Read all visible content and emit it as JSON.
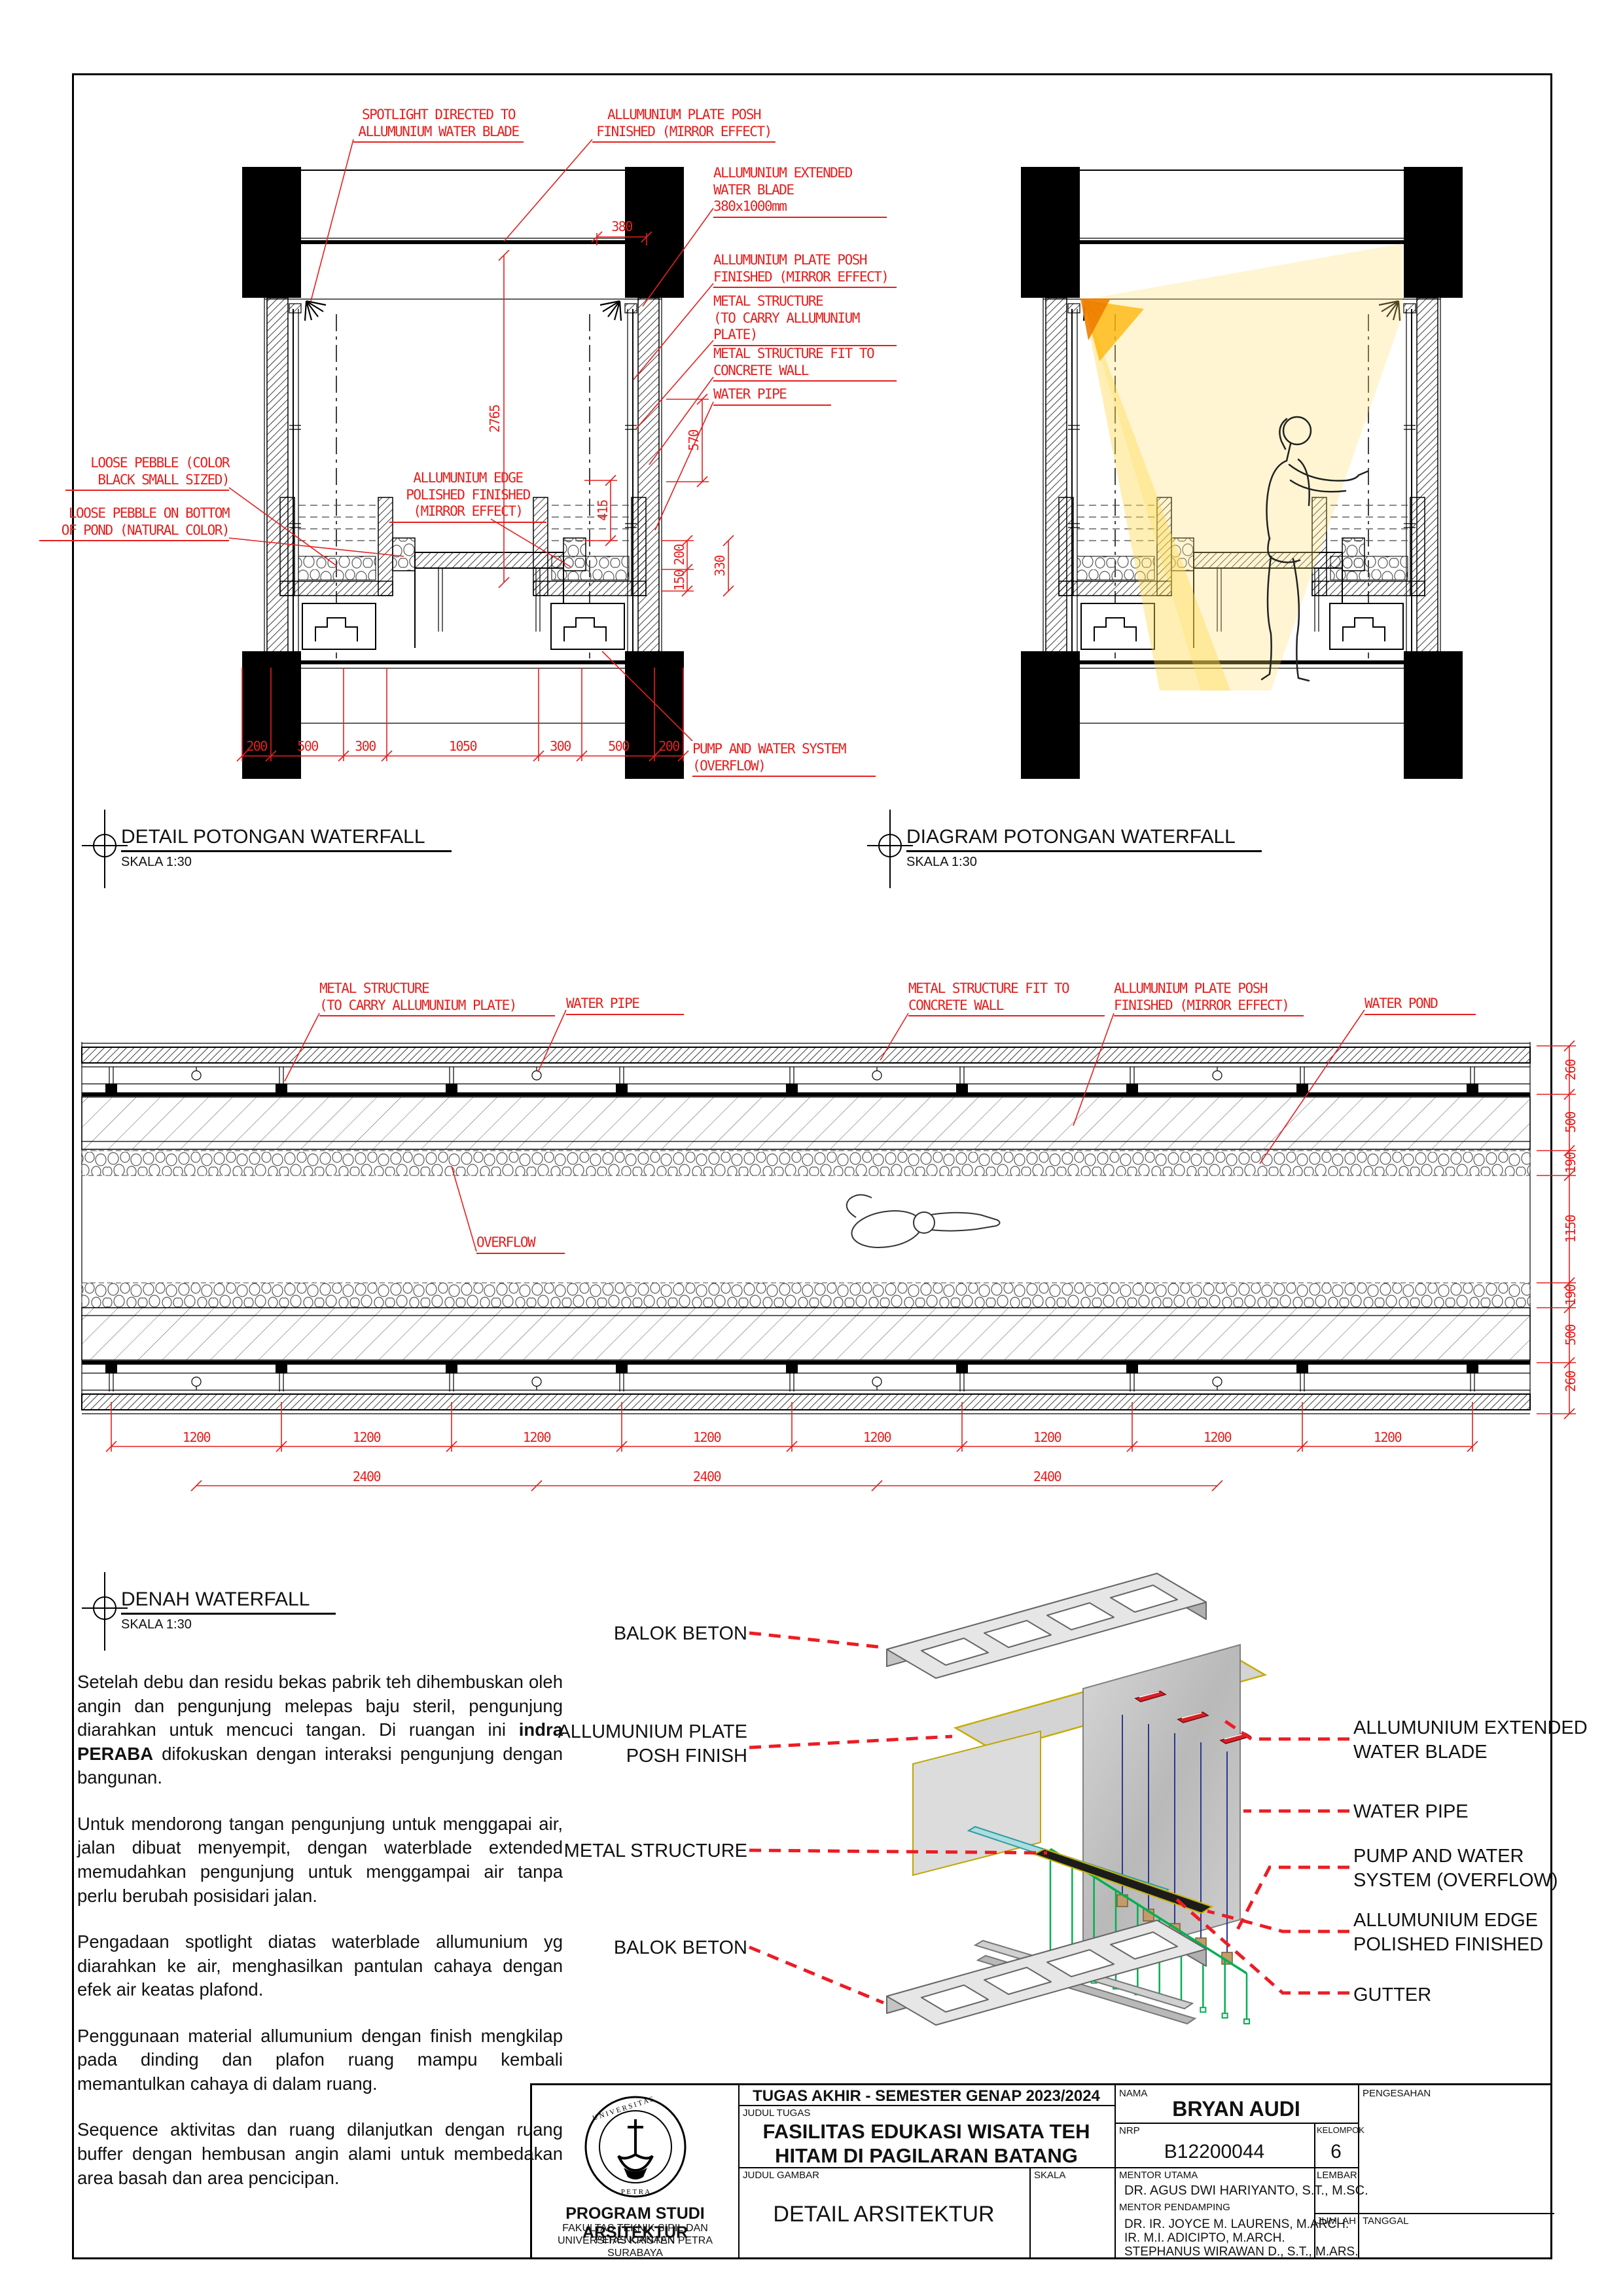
{
  "colors": {
    "annotation_red": "#e3201f",
    "leader_red": "#ed1c24",
    "structure_green": "#00b050",
    "pipe_blue": "#2b3990",
    "gutter_cyan": "#9fd8dc",
    "spotlight_yellow": "#ffd84d",
    "plate_edge_yellow": "#c6ac00"
  },
  "detail_section": {
    "title": "DETAIL POTONGAN WATERFALL",
    "scale_label": "SKALA 1:30",
    "labels": {
      "spotlight": "SPOTLIGHT DIRECTED TO\nALLUMUNIUM WATER BLADE",
      "plate_top": "ALLUMUNIUM PLATE POSH\nFINISHED (MIRROR EFFECT)",
      "water_blade": "ALLUMUNIUM EXTENDED\nWATER BLADE\n380x1000mm",
      "plate_right": "ALLUMUNIUM PLATE POSH\nFINISHED (MIRROR EFFECT)",
      "metal_carry": "METAL STRUCTURE\n(TO CARRY ALLUMUNIUM\nPLATE)",
      "metal_fit": "METAL STRUCTURE FIT TO\nCONCRETE WALL",
      "water_pipe": "WATER PIPE",
      "pebble_black": "LOOSE PEBBLE (COLOR\nBLACK SMALL SIZED)",
      "pebble_bottom": "LOOSE PEBBLE ON BOTTOM\nOF POND (NATURAL COLOR)",
      "alu_edge": "ALLUMUNIUM EDGE\nPOLISHED FINISHED\n(MIRROR EFFECT)",
      "pump": "PUMP AND WATER SYSTEM\n(OVERFLOW)"
    },
    "dims": {
      "w380": "380",
      "h2765": "2765",
      "h570": "570",
      "h415": "415",
      "h200": "200",
      "h150": "150",
      "h330": "330",
      "bottom": [
        "200",
        "500",
        "300",
        "1050",
        "300",
        "500",
        "200"
      ]
    }
  },
  "diagram_section": {
    "title": "DIAGRAM POTONGAN WATERFALL",
    "scale_label": "SKALA 1:30"
  },
  "plan": {
    "title": "DENAH WATERFALL",
    "scale_label": "SKALA 1:30",
    "labels": {
      "metal_carry": "METAL STRUCTURE\n(TO CARRY ALLUMUNIUM PLATE)",
      "water_pipe": "WATER PIPE",
      "metal_fit": "METAL STRUCTURE FIT TO\nCONCRETE WALL",
      "plate": "ALLUMUNIUM PLATE POSH\nFINISHED (MIRROR EFFECT)",
      "water_pond": "WATER POND",
      "overflow": "OVERFLOW"
    },
    "dims": {
      "right": [
        "260",
        "500",
        "190",
        "1150",
        "190",
        "500",
        "260"
      ],
      "bottom_1200": [
        "1200",
        "1200",
        "1200",
        "1200",
        "1200",
        "1200",
        "1200",
        "1200"
      ],
      "bottom_2400": [
        "2400",
        "2400",
        "2400"
      ]
    }
  },
  "axon": {
    "labels": {
      "balok_beton_top": "BALOK BETON",
      "plate_posh": "ALLUMUNIUM PLATE\nPOSH FINISH",
      "metal_structure": "METAL STRUCTURE",
      "balok_beton_bottom": "BALOK BETON",
      "water_blade": "ALLUMUNIUM EXTENDED\nWATER BLADE",
      "water_pipe": "WATER PIPE",
      "pump": "PUMP AND WATER\nSYSTEM (OVERFLOW)",
      "alu_edge": "ALLUMUNIUM EDGE\nPOLISHED FINISHED",
      "gutter": "GUTTER"
    }
  },
  "notes": {
    "p1_pre": "Setelah debu dan residu bekas  pabrik teh dihembuskan oleh angin dan pengunjung melepas baju steril, pengunjung diarahkan untuk mencuci tangan. Di ruangan ini ",
    "p1_bold": "indra PERABA",
    "p1_post": " difokuskan dengan interaksi pengunjung dengan bangunan.",
    "p2": "Untuk mendorong tangan pengunjung untuk menggapai air, jalan dibuat menyempit, dengan waterblade extended memudahkan pengunjung untuk menggampai air tanpa perlu berubah posisidari jalan.",
    "p3": "Pengadaan spotlight diatas waterblade allumunium yg diarahkan ke air, menghasilkan pantulan cahaya dengan efek air keatas plafond.",
    "p4": "Penggunaan material allumunium dengan finish mengkilap pada dinding dan plafon ruang mampu kembali memantulkan cahaya di dalam ruang.",
    "p5": "Sequence aktivitas dan ruang dilanjutkan dengan ruang buffer dengan hembusan angin alami untuk membedakan area basah dan area pencicipan."
  },
  "titleblock": {
    "header": "TUGAS AKHIR - SEMESTER GENAP 2023/2024",
    "judul_tugas_label": "JUDUL TUGAS",
    "judul_tugas": "FASILITAS EDUKASI WISATA TEH\nHITAM DI PAGILARAN BATANG",
    "judul_gambar_label": "JUDUL GAMBAR",
    "judul_gambar": "DETAIL ARSITEKTUR",
    "skala_label": "SKALA",
    "nama_label": "NAMA",
    "nama": "BRYAN AUDI",
    "nrp_label": "NRP",
    "nrp": "B12200044",
    "kelompok_label": "KELOMPOK",
    "kelompok": "6",
    "mentor_utama_label": "MENTOR UTAMA",
    "mentor_utama": "DR. AGUS DWI HARIYANTO, S.T., M.SC.",
    "mentor_pendamping_label": "MENTOR PENDAMPING",
    "pendamping": [
      "DR. IR. JOYCE M. LAURENS, M.ARCH.",
      "IR. M.I. ADICIPTO, M.ARCH.",
      "STEPHANUS WIRAWAN D., S.T., M.ARS."
    ],
    "lembar_label": "LEMBAR",
    "jumlah_label": "JUMLAH",
    "pengesahan_label": "PENGESAHAN",
    "tanggal_label": "TANGGAL",
    "institution": {
      "program": "PROGRAM STUDI ARSITEKTUR",
      "lines": [
        "FAKULTAS TEKNIK SIPIL DAN PERENCANAAN",
        "UNIVERSITAS KRISTEN PETRA",
        "SURABAYA"
      ]
    }
  }
}
